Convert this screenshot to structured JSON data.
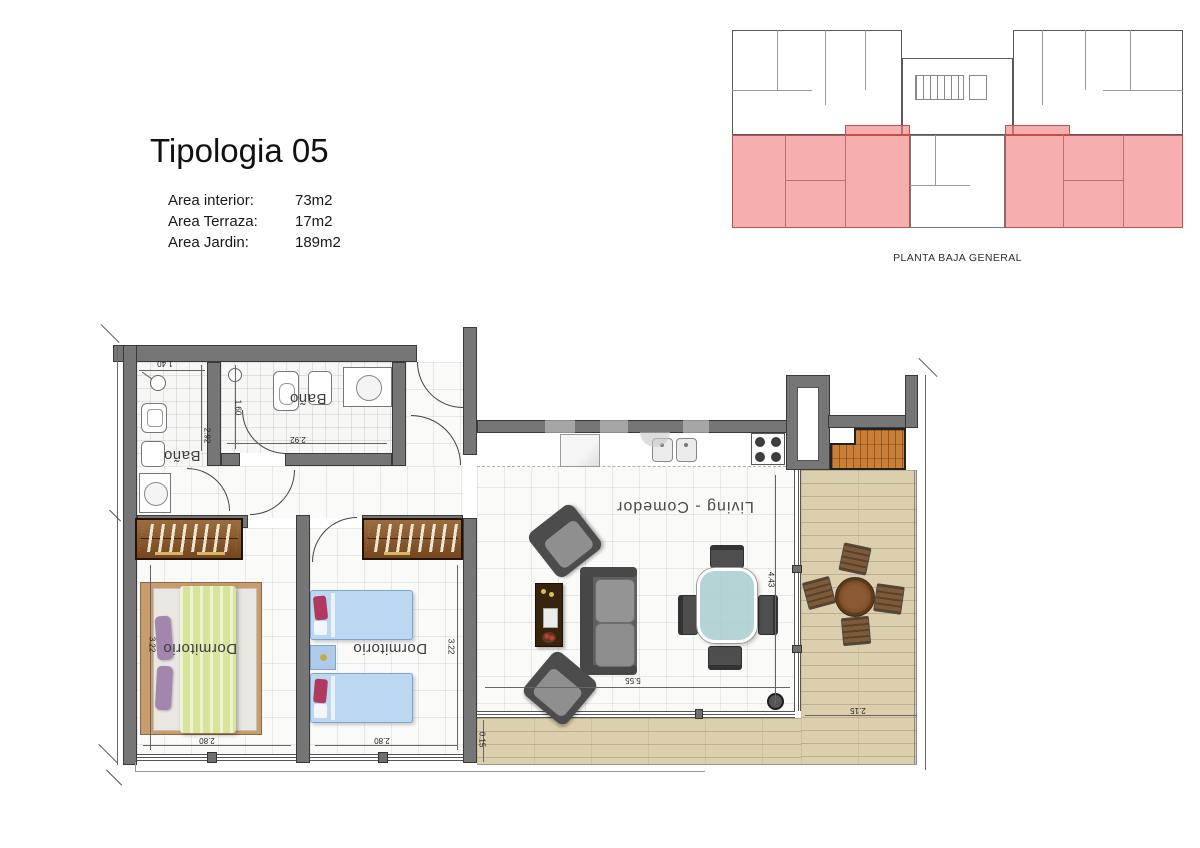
{
  "header": {
    "title": "Tipologia 05",
    "areas": [
      {
        "label": "Area interior:",
        "value": "73m2"
      },
      {
        "label": "Area Terraza:",
        "value": "17m2"
      },
      {
        "label": "Area Jardin:",
        "value": "189m2"
      }
    ]
  },
  "overview": {
    "caption": "PLANTA BAJA GENERAL",
    "highlight_color": "#f29191"
  },
  "plan": {
    "labels": {
      "bath1": "Baño",
      "bath2": "Baño",
      "bedroom1": "Dormitorio",
      "bedroom2": "Dormitorio",
      "living": "Living - Comedor"
    },
    "dimensions": {
      "bath1_width": "1.40",
      "bath1_depth": "2.92",
      "bath2_width": "2.92",
      "bath2_depth": "1.60",
      "bedroom1_width": "2.80",
      "bedroom1_depth": "3.22",
      "bedroom2_width": "2.80",
      "bedroom2_depth": "3.22",
      "living_width": "5.55",
      "living_depth": "4.43",
      "terrace_width": "2.15",
      "deck_strip_depth": "0.15"
    },
    "colors": {
      "wall": "#767676",
      "deck_wood": "#dbcfae",
      "closet_wood": "#8a5322",
      "tile_storage": "#c97f35",
      "bed_double_blanket": "#d8e39b",
      "bed_single": "#bcd7f2"
    }
  }
}
